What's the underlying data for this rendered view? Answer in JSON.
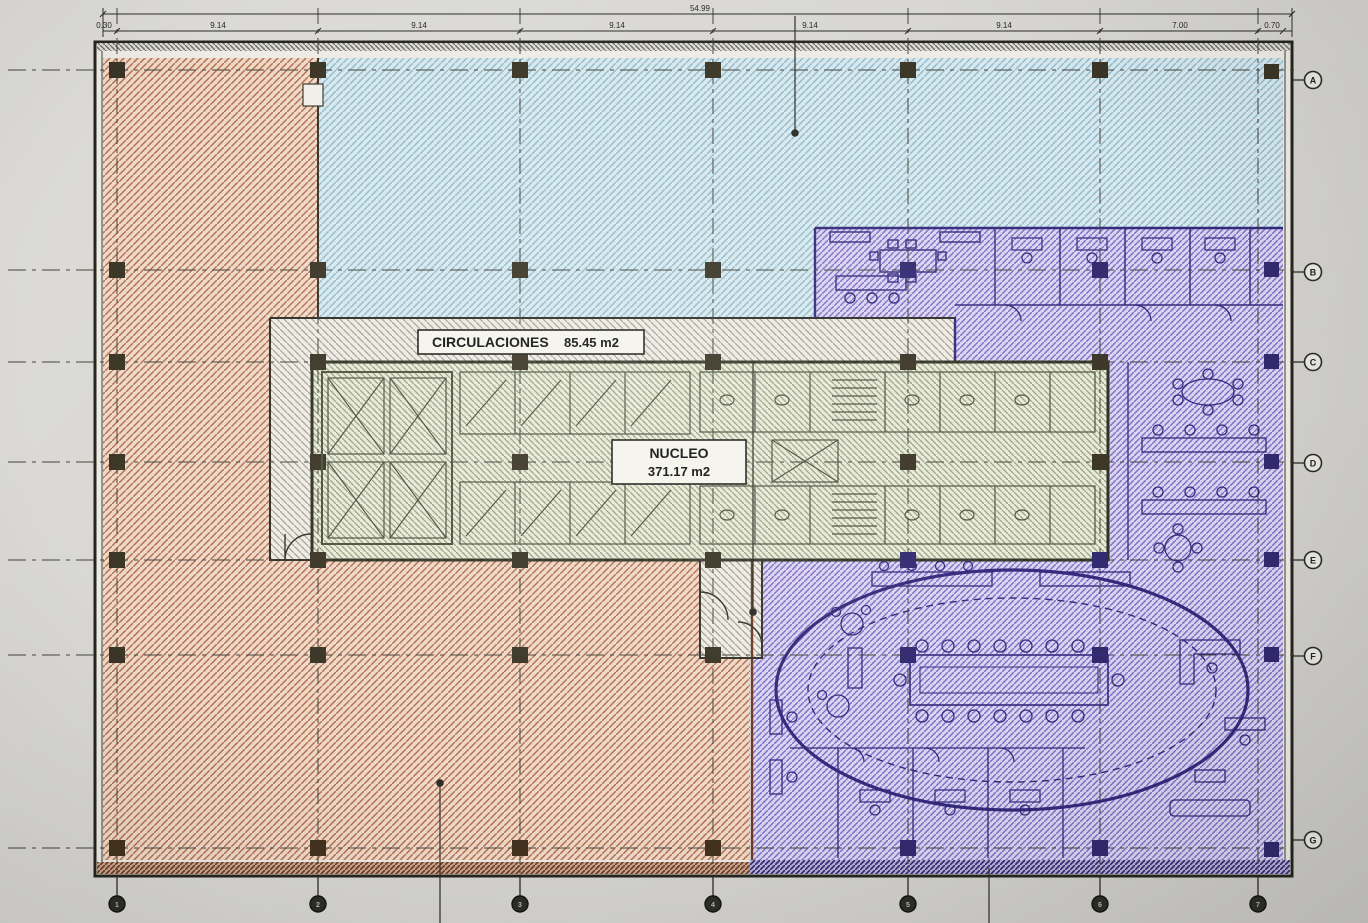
{
  "plan": {
    "title": "Floor plan zoning photo",
    "labels": {
      "circulaciones": {
        "name": "CIRCULACIONES",
        "area": "85.45 m2"
      },
      "nucleo": {
        "name": "NUCLEO",
        "area": "371.17 m2"
      }
    },
    "grid": {
      "rows": [
        "A",
        "B",
        "C",
        "D",
        "E",
        "F",
        "G"
      ],
      "cols": [
        "1",
        "2",
        "3",
        "4",
        "5",
        "6",
        "7"
      ]
    },
    "dimensions": {
      "total": "54.99",
      "left_offset": "0.30",
      "segments": [
        "9.14",
        "9.14",
        "9.14",
        "9.14",
        "9.14",
        "7.00",
        "0.70"
      ]
    },
    "zones": {
      "orange": {
        "id": "office-zone-orange",
        "color": "#b56f52"
      },
      "blue": {
        "id": "open-zone-blue",
        "color": "#8fbccb"
      },
      "purple": {
        "id": "office-zone-purple",
        "color": "#7d6fc6"
      },
      "green": {
        "id": "nucleo-zone-green",
        "color": "#98a27d"
      },
      "gray": {
        "id": "circulation-zone-gray",
        "color": "#a5a296"
      }
    }
  }
}
